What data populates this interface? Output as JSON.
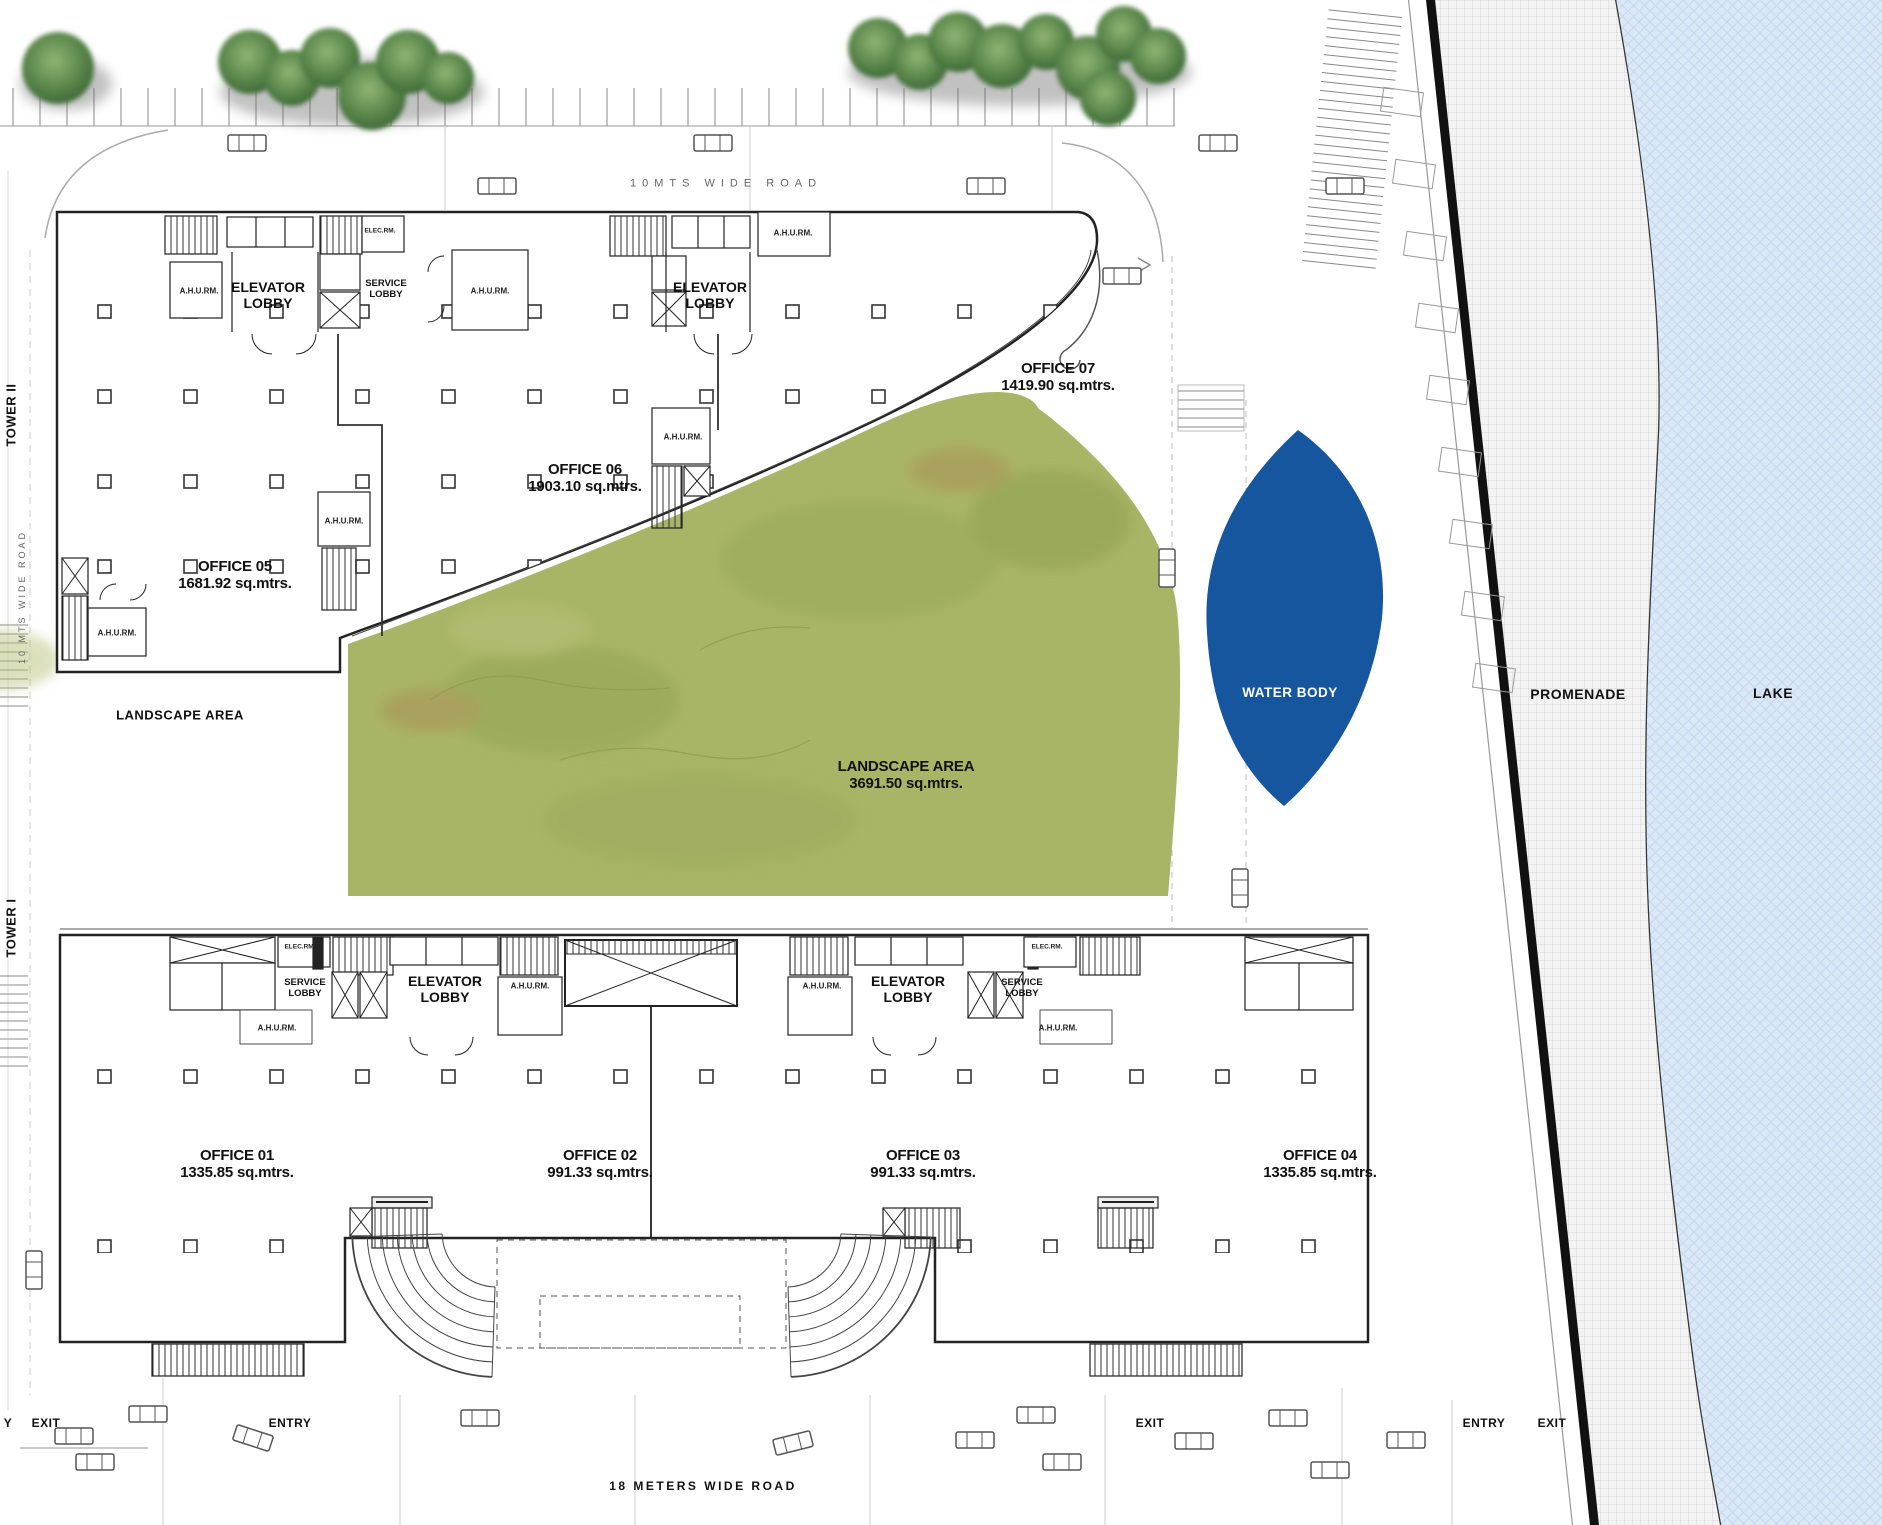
{
  "labels": {
    "road_top": "10MTS WIDE ROAD",
    "road_bottom": "18 METERS WIDE ROAD",
    "road_left": "10 MTS WIDE ROAD",
    "tower_1": "TOWER I",
    "tower_2": "TOWER II",
    "elevator_lobby": "ELEVATOR LOBBY",
    "service_lobby": "SERVICE LOBBY",
    "ahu_room": "A.H.U.RM.",
    "elec_room": "ELEC.RM.",
    "landscape_area": "LANDSCAPE AREA",
    "water_body": "WATER BODY",
    "promenade": "PROMENADE",
    "lake": "LAKE",
    "entry": "ENTRY",
    "exit": "EXIT",
    "entry_partial": "Y"
  },
  "offices": [
    {
      "name": "OFFICE 01",
      "area": "1335.85 sq.mtrs."
    },
    {
      "name": "OFFICE 02",
      "area": "991.33 sq.mtrs."
    },
    {
      "name": "OFFICE 03",
      "area": "991.33 sq.mtrs."
    },
    {
      "name": "OFFICE 04",
      "area": "1335.85 sq.mtrs."
    },
    {
      "name": "OFFICE 05",
      "area": "1681.92 sq.mtrs."
    },
    {
      "name": "OFFICE 06",
      "area": "1903.10 sq.mtrs."
    },
    {
      "name": "OFFICE 07",
      "area": "1419.90 sq.mtrs."
    }
  ],
  "landscape": {
    "name": "LANDSCAPE AREA",
    "area": "3691.50 sq.mtrs."
  },
  "colors": {
    "water": "#15569E",
    "landscape": "#A9B566",
    "lake": "#DBE8F6",
    "line": "#1F1F1F",
    "tree": "#5E8A4E"
  }
}
